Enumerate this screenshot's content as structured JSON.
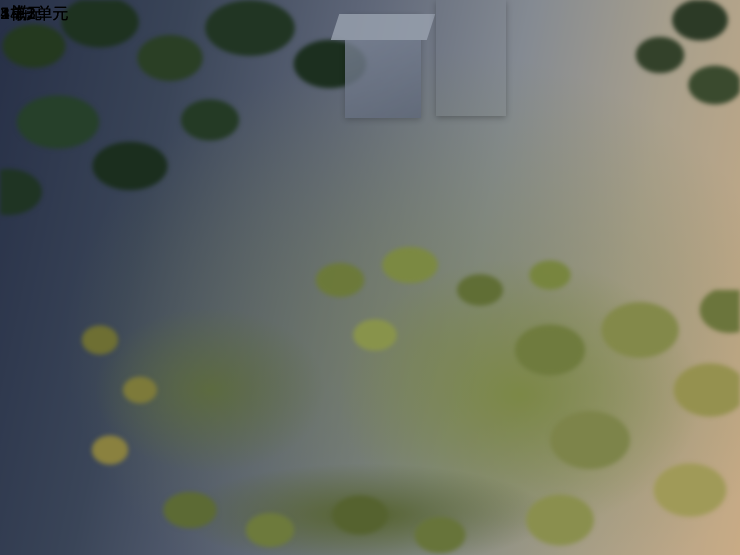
{
  "building_labels": [
    {
      "id": "building-3",
      "text": "3 栋"
    },
    {
      "id": "building-4",
      "text": "4 栋"
    },
    {
      "id": "building-5",
      "text": "5 栋"
    }
  ],
  "unit_labels": [
    {
      "id": "unit-2",
      "text": "2单元"
    },
    {
      "id": "unit-1",
      "text": "1单元"
    },
    {
      "id": "unit-3",
      "text": "3单元"
    }
  ],
  "unit_badges": [
    {
      "id": "badge-building2-unit2",
      "text": "2栋2单元"
    },
    {
      "id": "badge-building1-unit3",
      "text": "1栋3单元"
    },
    {
      "id": "badge-building1-unit2",
      "text": "1栋2单元"
    },
    {
      "id": "badge-building1-unit1",
      "text": "1栋1单元"
    },
    {
      "id": "badge-building2-unit1",
      "text": "2栋1单元"
    }
  ],
  "colors": {
    "building_label_cyan": "#38B1E8",
    "unit_label_yellow": "#FFC614",
    "badge_background": "#F1B70F",
    "badge_text": "#332300",
    "roof_terracotta": "#B0603F",
    "track_ring": "#BF6F75",
    "lawn_green": "#84AE47"
  }
}
